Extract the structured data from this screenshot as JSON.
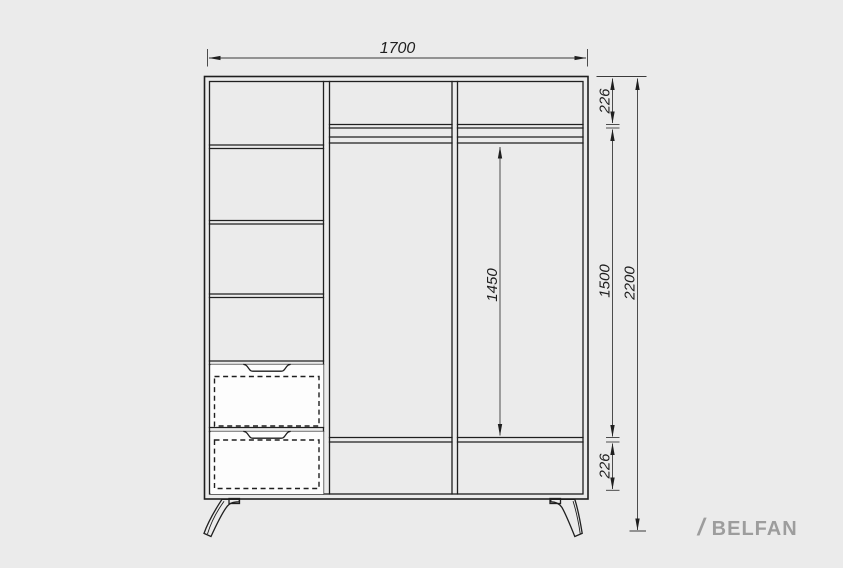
{
  "colors": {
    "background": "#EBEBEB",
    "line": "#1F1F1F",
    "dimline": "#3A3A3A",
    "drawer": "#FDFDFD",
    "brand": "#9D9D9D"
  },
  "dimensions": {
    "overall_width": "1700",
    "top_section_height": "226",
    "hanging_space_height": "1450",
    "interior_height": "1500",
    "overall_height": "2200",
    "bottom_section_height": "226"
  },
  "brand": {
    "slash": "/",
    "name": "BELFAN"
  }
}
